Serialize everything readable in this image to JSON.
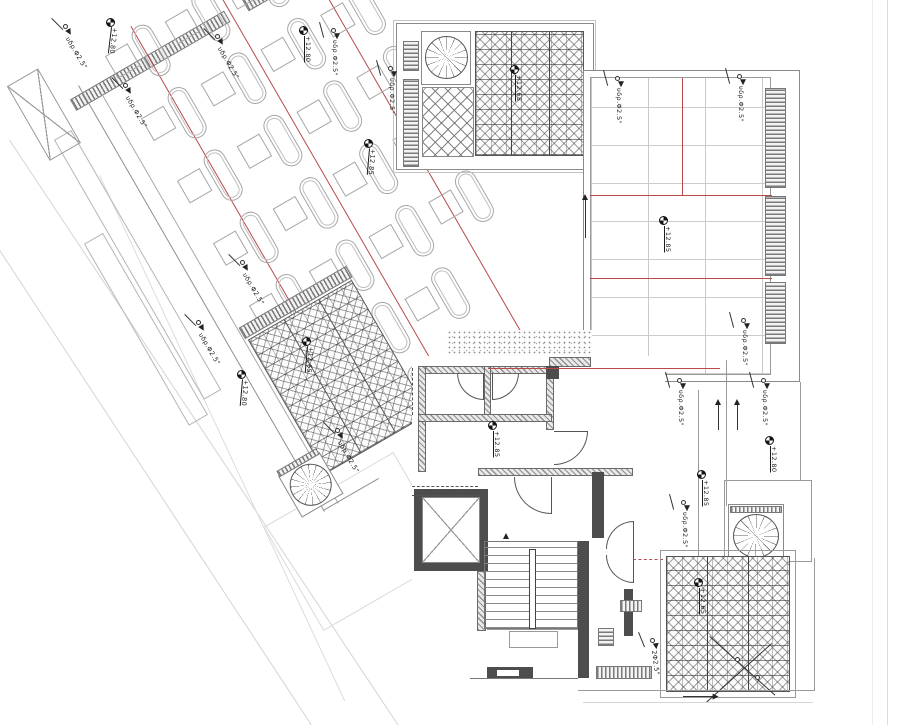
{
  "drawing": {
    "description": "architectural roof terrace plan",
    "colors": {
      "joint_red": "#b84a4a",
      "line_gray": "#8a8a8a",
      "wall_dark": "#4d4d4d"
    },
    "annotations": {
      "drain_default_label": "υδρ.Φ2.5\"",
      "level_markers": [
        {
          "x": 110,
          "y": 22,
          "rot": 97,
          "label": "+12.80"
        },
        {
          "x": 303,
          "y": 30,
          "rot": 90,
          "label": "+12.80"
        },
        {
          "x": 368,
          "y": 143,
          "rot": 95,
          "label": "+12.85"
        },
        {
          "x": 514,
          "y": 69,
          "rot": 90,
          "label": "+12.65"
        },
        {
          "x": 663,
          "y": 220,
          "rot": 90,
          "label": "+12.85"
        },
        {
          "x": 241,
          "y": 374,
          "rot": 95,
          "label": "+12.80"
        },
        {
          "x": 769,
          "y": 440,
          "rot": 90,
          "label": "+12.80"
        },
        {
          "x": 701,
          "y": 474,
          "rot": 90,
          "label": "+12.85"
        },
        {
          "x": 492,
          "y": 425,
          "rot": 90,
          "label": "+12.85"
        },
        {
          "x": 306,
          "y": 341,
          "rot": 95,
          "label": "+12.65"
        },
        {
          "x": 698,
          "y": 582,
          "rot": 90,
          "label": "+12.65"
        }
      ],
      "drain_labels": [
        {
          "x": 70,
          "y": 36,
          "rot": 60
        },
        {
          "x": 130,
          "y": 95,
          "rot": 60
        },
        {
          "x": 222,
          "y": 46,
          "rot": 60
        },
        {
          "x": 338,
          "y": 40,
          "rot": 90
        },
        {
          "x": 395,
          "y": 78,
          "rot": 90
        },
        {
          "x": 247,
          "y": 272,
          "rot": 60
        },
        {
          "x": 203,
          "y": 332,
          "rot": 60
        },
        {
          "x": 622,
          "y": 88,
          "rot": 90
        },
        {
          "x": 744,
          "y": 86,
          "rot": 90
        },
        {
          "x": 748,
          "y": 330,
          "rot": 90
        },
        {
          "x": 684,
          "y": 390,
          "rot": 90
        },
        {
          "x": 768,
          "y": 390,
          "rot": 90
        },
        {
          "x": 688,
          "y": 512,
          "rot": 90
        },
        {
          "x": 342,
          "y": 440,
          "rot": 60
        },
        {
          "x": 657,
          "y": 650,
          "rot": 83,
          "label": "2Φ2.5\""
        }
      ]
    },
    "deck": {
      "angle_deg": -30,
      "anchor": [
        88,
        103
      ],
      "lounger_columns_x": [
        38,
        107,
        176,
        245
      ],
      "rows": [
        {
          "y": -44,
          "cols": [
            0,
            1,
            2,
            3
          ]
        },
        {
          "y": 28,
          "cols": [
            0,
            1,
            2,
            3
          ]
        },
        {
          "y": 100,
          "cols": [
            0,
            1,
            2,
            3
          ]
        },
        {
          "y": 172,
          "cols": [
            0,
            1,
            2,
            3
          ]
        },
        {
          "y": 244,
          "cols": [
            0,
            1,
            2,
            3
          ]
        },
        {
          "y": 316,
          "cols": [
            0,
            1,
            2
          ]
        },
        {
          "y": 388,
          "cols": [
            1,
            2
          ]
        },
        {
          "y": 460,
          "cols": [
            1,
            2
          ]
        }
      ]
    }
  }
}
